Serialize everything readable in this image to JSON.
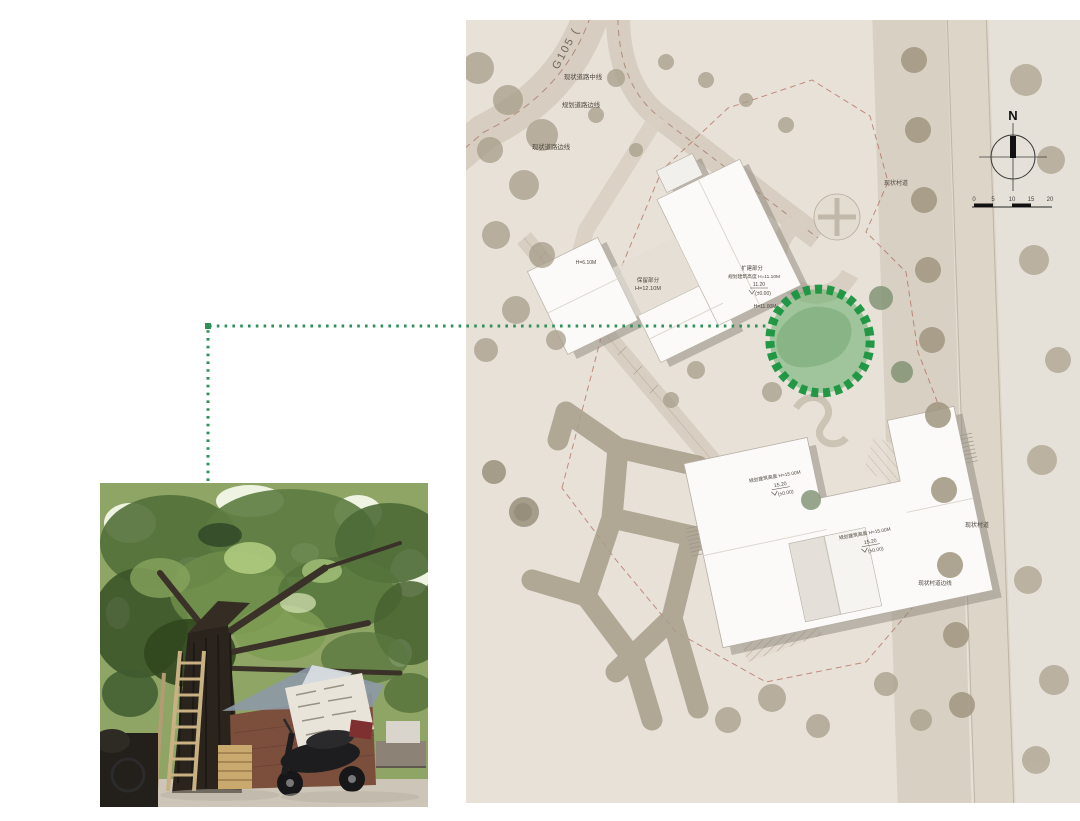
{
  "colors": {
    "map_background": "#e9e4dc",
    "highlight_green": "#18953f",
    "highlight_fill": "#5aa85e",
    "leader_green": "#2f9158",
    "boundary_red": "#ad5a4b"
  },
  "site_plan": {
    "labels": {
      "g105": "G105 (",
      "existing_road_centerline": "现状道路中线",
      "planned_road_edge": "规划道路边线",
      "existing_road_edge": "现状道路边线",
      "village_road_right": "现状村道",
      "village_road_bottom": "现状村道",
      "village_road_edge_bottom": "现状村道边线",
      "left_block_height": "H=6.10M",
      "retained_part": "保留部分",
      "retained_height": "H=12.10M",
      "extension_part": "扩建部分",
      "extension_height": "规划建筑高度 H=11.10M",
      "extension_level": "11.20",
      "extension_datum": "(±0.00)",
      "east_wing_height": "H=11.00M",
      "lower_nw_height": "规划建筑高度 H=15.00M",
      "lower_nw_level": "15.20",
      "lower_nw_datum": "(±0.00)",
      "lower_e_height": "规划建筑高度 H=15.00M",
      "lower_e_level": "15.20",
      "lower_e_datum": "(±0.00)"
    },
    "compass": {
      "north": "N"
    },
    "scale_bar": {
      "ticks": [
        "0",
        "5",
        "10",
        "15",
        "20"
      ]
    }
  }
}
